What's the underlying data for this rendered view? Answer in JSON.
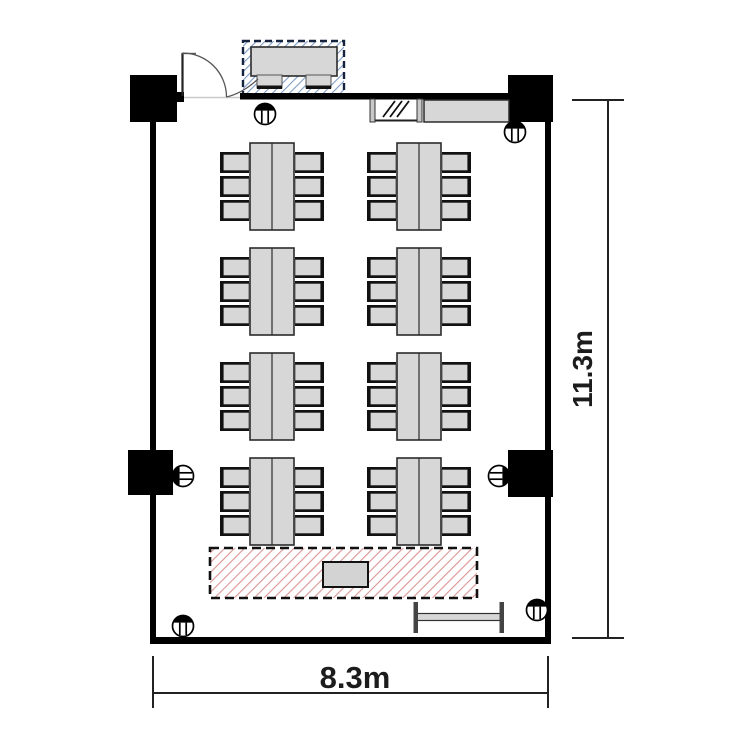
{
  "page": {
    "title": "Meeting room floor plan",
    "background": "#ffffff"
  },
  "dimensions": {
    "width_label": "8.3m",
    "height_label": "11.3m"
  },
  "colors": {
    "wall": "#000000",
    "furniture_fill": "#d7d7d7",
    "furniture_stroke": "#2b2b2b",
    "stage_hatch_line": "#dc9494",
    "stage_border": "#111111",
    "reception_hatch_line": "#7e9cc6",
    "reception_border": "#16233e",
    "dimension_line": "#222222",
    "door_arc": "#555555"
  },
  "furniture": {
    "table_groups": {
      "count": 8,
      "tables_per_group": 2,
      "chairs_per_group": 6,
      "columns_x": [
        250,
        397
      ],
      "rows_y": [
        143,
        248,
        353,
        458
      ],
      "table_w": 44,
      "table_h": 87,
      "chair_rows": 3,
      "chair_pitch": 24,
      "chair_top_offset": 9,
      "chair_w": 29
    },
    "speakers": [
      {
        "x": 265,
        "y": 114,
        "facing": "up"
      },
      {
        "x": 515,
        "y": 132,
        "facing": "up"
      },
      {
        "x": 183,
        "y": 476,
        "facing": "left"
      },
      {
        "x": 499,
        "y": 476,
        "facing": "right"
      },
      {
        "x": 183,
        "y": 626,
        "facing": "up"
      },
      {
        "x": 537,
        "y": 610,
        "facing": "up"
      }
    ],
    "stage": {
      "name": "stage-area",
      "has_podium": true
    },
    "reception": {
      "name": "reception-desk",
      "chairs": 2
    },
    "counter": {
      "name": "counter-cabinet"
    },
    "side_table": {
      "name": "folded-side-table"
    },
    "pillars": 4,
    "total_chairs": 50
  }
}
